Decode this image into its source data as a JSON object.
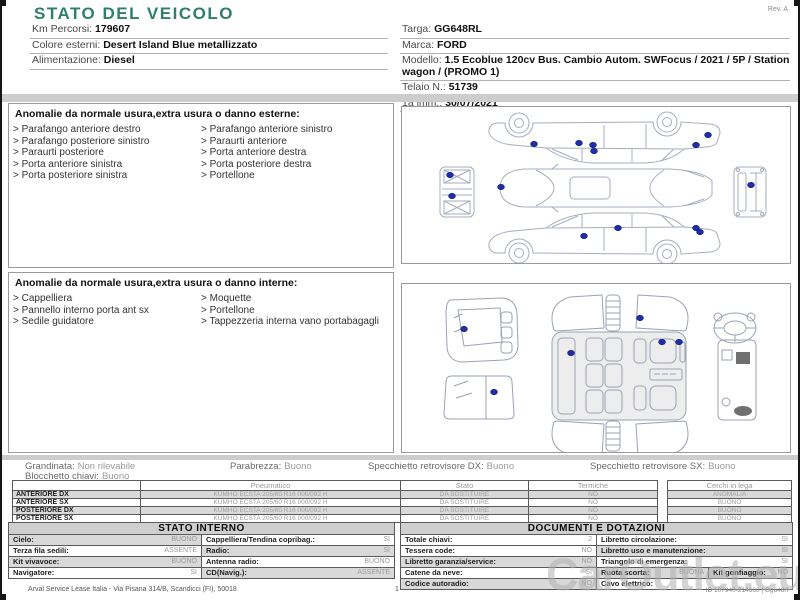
{
  "colors": {
    "accent_teal": "#2e7f6b",
    "damage_marker_blue": "#1f2da8"
  },
  "header": {
    "title": "STATO DEL VEICOLO",
    "rev": "Rev. A"
  },
  "vehicle_info": {
    "left": [
      {
        "label": "Km Percorsi:",
        "value": "179607"
      },
      {
        "label": "Colore esterni:",
        "value": "Desert Island Blue metallizzato"
      },
      {
        "label": "Alimentazione:",
        "value": "Diesel"
      }
    ],
    "right": [
      {
        "label": "Targa:",
        "value": "GG648RL"
      },
      {
        "label": "Marca:",
        "value": "FORD"
      },
      {
        "label": "Modello:",
        "value": "1.5 Ecoblue 120cv Bus. Cambio Autom. SWFocus / 2021 / 5P / Station wagon / (PROMO 1)"
      },
      {
        "label": "Telaio N.:",
        "value": "51739"
      },
      {
        "label": "1a imm.:",
        "value": "30/07/2021"
      }
    ]
  },
  "anomalies_external": {
    "title": "Anomalie da normale usura,extra usura o danno esterne:",
    "col1": [
      "Parafango anteriore destro",
      "Parafango posteriore sinistro",
      "Paraurti posteriore",
      "Porta anteriore sinistra",
      "Porta posteriore sinistra"
    ],
    "col2": [
      "Parafango anteriore sinistro",
      "Paraurti anteriore",
      "Porta anteriore destra",
      "Porta posteriore destra",
      "Portellone"
    ]
  },
  "anomalies_internal": {
    "title": "Anomalie da normale usura,extra usura o danno interne:",
    "col1": [
      "Cappelliera",
      "Pannello interno porta ant sx",
      "Sedile guidatore"
    ],
    "col2": [
      "Moquette",
      "Portellone",
      "Tappezzeria interna vano portabagagli"
    ]
  },
  "condition_summary": {
    "grandinata": {
      "label": "Grandinata:",
      "value": "Non rilevabile"
    },
    "parabrezza": {
      "label": "Parabrezza:",
      "value": "Buono"
    },
    "specchietto_dx": {
      "label": "Specchietto retrovisore DX:",
      "value": "Buono"
    },
    "specchietto_sx": {
      "label": "Specchietto retrovisore SX:",
      "value": "Buono"
    },
    "blocchetto": {
      "label": "Blocchetto chiavi:",
      "value": "Buono"
    }
  },
  "tires": {
    "header_pneumatico": "Pneumatico",
    "header_stato": "Stato",
    "header_termiche": "Termiche",
    "header_cerchi": "Cerchi in lega",
    "rows": [
      {
        "pos": "ANTERIORE DX",
        "tire": "KUMHO ECSTA 205/60 R16 000/092 H",
        "stato": "DA SOSTITUIRE",
        "termiche": "NO",
        "cerchi": "ANOMALIA"
      },
      {
        "pos": "ANTERIORE SX",
        "tire": "KUMHO ECSTA 205/60 R16 000/092 H",
        "stato": "DA SOSTITUIRE",
        "termiche": "NO",
        "cerchi": "BUONO"
      },
      {
        "pos": "POSTERIORE DX",
        "tire": "KUMHO ECSTA 205/60 R16 000/092 H",
        "stato": "DA SOSTITUIRE",
        "termiche": "NO",
        "cerchi": "BUONO"
      },
      {
        "pos": "POSTERIORE SX",
        "tire": "KUMHO ECSTA 205/60 R16 000/092 H",
        "stato": "DA SOSTITUIRE",
        "termiche": "NO",
        "cerchi": "BUONO"
      }
    ]
  },
  "stato_interno": {
    "title": "STATO INTERNO",
    "rows": [
      {
        "l_label": "Cielo:",
        "l_value": "BUONO",
        "r_label": "Cappelliera/Tendina copribag.:",
        "r_value": "SI"
      },
      {
        "l_label": "Terza fila sedili:",
        "l_value": "ASSENTE",
        "r_label": "Radio:",
        "r_value": "SI"
      },
      {
        "l_label": "Kit vivavoce:",
        "l_value": "BUONO",
        "r_label": "Antenna radio:",
        "r_value": "BUONO"
      },
      {
        "l_label": "Navigatore:",
        "l_value": "SI",
        "r_label": "CD(Navig.):",
        "r_value": "ASSENTE"
      }
    ]
  },
  "documenti": {
    "title": "DOCUMENTI E DOTAZIONI",
    "rows": [
      {
        "l_label": "Totale chiavi:",
        "l_value": "2",
        "r_label": "Libretto circolazione:",
        "r_value": "SI"
      },
      {
        "l_label": "Tessera code:",
        "l_value": "NO",
        "r_label": "Libretto uso e manutenzione:",
        "r_value": "SI"
      },
      {
        "l_label": "Libretto garanzia/service:",
        "l_value": "NO",
        "r_label": "Triangolo di emergenza:",
        "r_value": "SI"
      },
      {
        "l_label": "Catene da neve:",
        "l_value": "SI",
        "r_label": "Ruota scorta:",
        "r_value": "BUONA",
        "r2_label": "Kit gonfiaggio:",
        "r2_value": "NO"
      },
      {
        "l_label": "Codice autoradio:",
        "l_value": "NO",
        "r_label": "Cavo elettrico:",
        "r_value": ""
      }
    ]
  },
  "footer": {
    "company": "Arval Service Lease Italia - Via Pisana 314/B, Scandicci (FI), 50018",
    "page": "1",
    "doc_id": "ID 107940-214660 | Gg648rl"
  },
  "watermark": "CarOutlet.eu"
}
